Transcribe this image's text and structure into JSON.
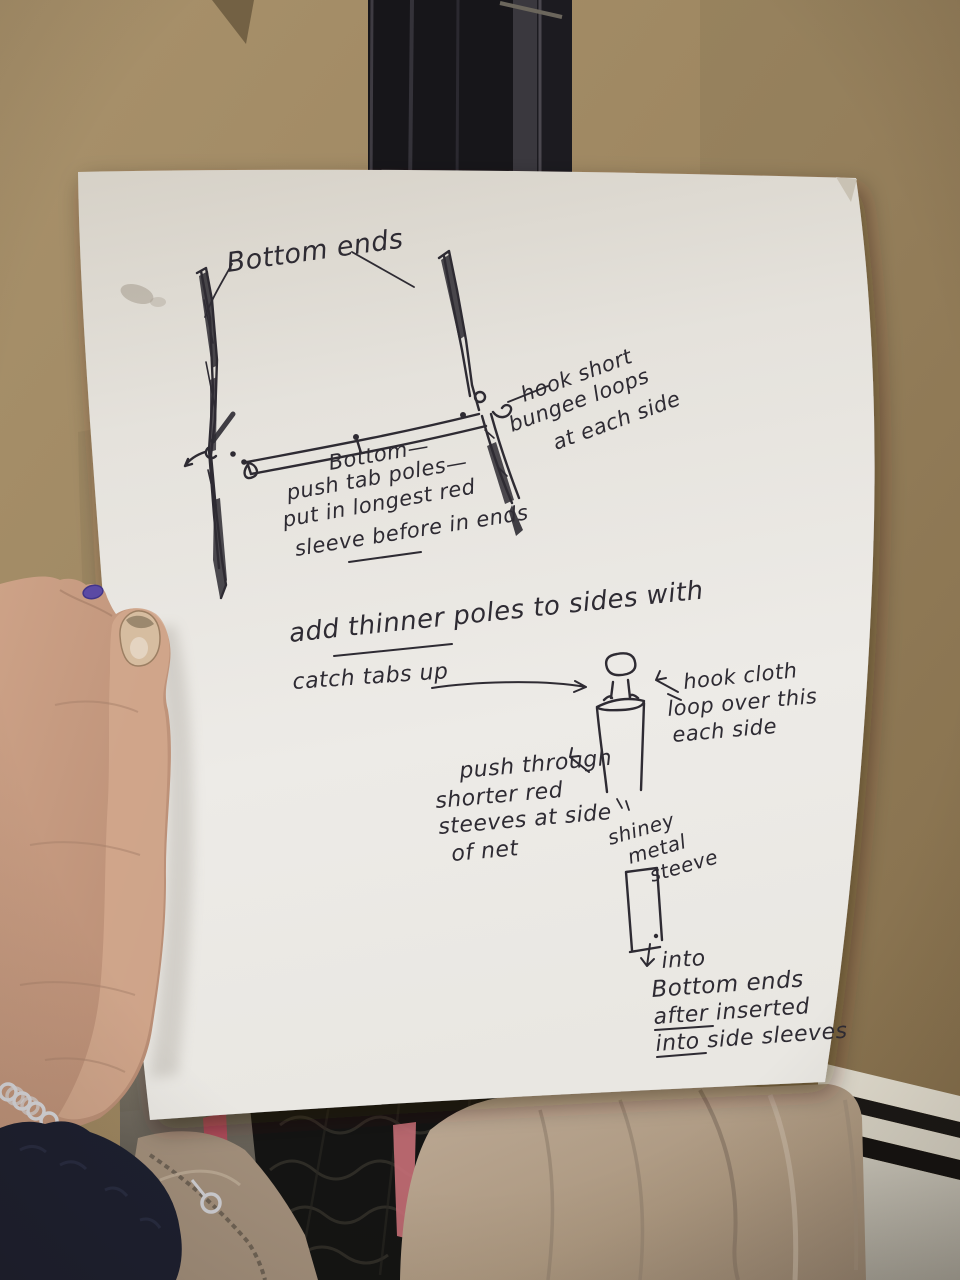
{
  "annotations": {
    "bottom_ends": "Bottom ends",
    "hook_bungee": [
      "hook short",
      "bungee loops",
      "at each side"
    ],
    "bottom_tab": [
      "Bottom—",
      "push tab poles—",
      "put in longest red",
      "sleeve before in ends"
    ],
    "add_thinner": [
      "add thinner poles to sides with",
      "catch tabs up"
    ],
    "hook_cloth": [
      "hook cloth",
      "loop over this",
      "each side"
    ],
    "push_through": [
      "push through",
      "shorter red",
      "steeves at side",
      "of net"
    ],
    "metal_sleeve": [
      "shiney",
      "metal",
      "steeve"
    ],
    "into_bottom": [
      "into",
      "Bottom ends",
      "after inserted",
      "into side sleeves"
    ]
  },
  "underlined_words": [
    "thinner",
    "before",
    "after",
    "into"
  ],
  "palette": {
    "wall": "#9d8660",
    "paper": "#e8e5df",
    "ink": "#2e2b33",
    "skin": "#c59c84",
    "skinlight": "#d7b097",
    "nail": "#d8c0a3",
    "polish": "#5b4aa4",
    "sleeve": "#1d2030",
    "mesh": "#141413",
    "bagtan": "#a9967f",
    "jacket": "#b3a08c",
    "radiator": "#ddd8ca",
    "pole": "#1a191c"
  }
}
